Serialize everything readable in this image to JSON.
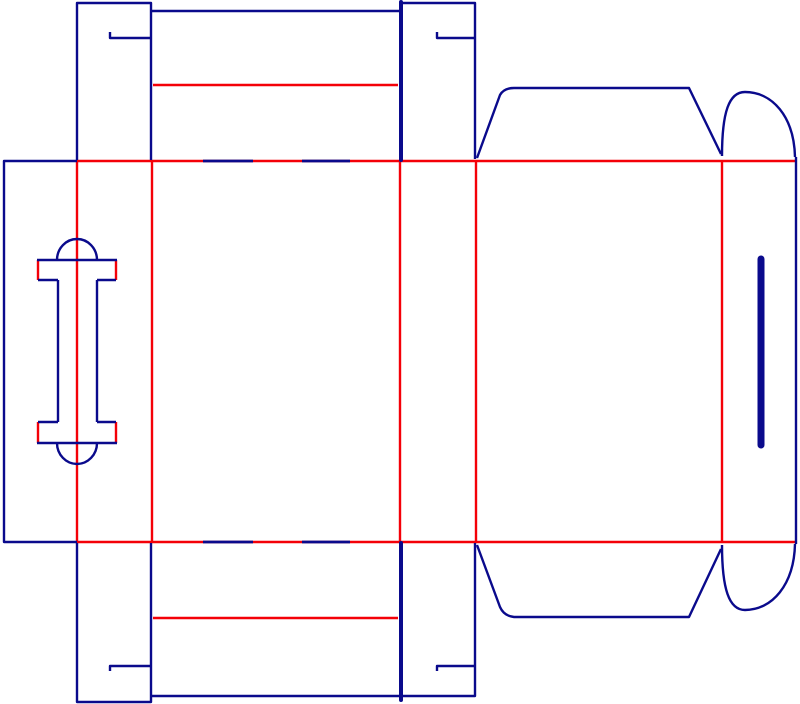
{
  "canvas": {
    "width": 800,
    "height": 704,
    "background": "#ffffff"
  },
  "colors": {
    "cut": "#0a0a8c",
    "crease": "#f40008"
  },
  "stroke": {
    "default": 2.4,
    "dash": 2.8,
    "flap_slit": 4,
    "thumb_slit": 7
  },
  "dieline": {
    "creases": [
      {
        "name": "fold-glue-flap",
        "points": "77,161 77,542"
      },
      {
        "name": "fold-handle-panel-right",
        "points": "152,161 152,542"
      },
      {
        "name": "fold-front-panel-right",
        "points": "400,161 400,542"
      },
      {
        "name": "fold-side-panel-right",
        "points": "476,161 476,542"
      },
      {
        "name": "fold-back-panel-right",
        "points": "722,161 722,542"
      },
      {
        "name": "crease-top-horizontal",
        "points": "77,161 795,161"
      },
      {
        "name": "crease-bottom-horizontal",
        "points": "77,542 795,542"
      },
      {
        "name": "crease-top-tuck-flap",
        "points": "153,85 398,85"
      },
      {
        "name": "crease-bottom-tuck-flap",
        "points": "153,618 398,618"
      },
      {
        "name": "crease-handle-top-left",
        "points": "38,260 38,280"
      },
      {
        "name": "crease-handle-top-right",
        "points": "116,260 116,280"
      },
      {
        "name": "crease-handle-bottom-left",
        "points": "38,422 38,443"
      },
      {
        "name": "crease-handle-bottom-right",
        "points": "116,422 116,443"
      }
    ],
    "cut_dashes": [
      {
        "name": "perforation-dash-top-1",
        "points": "203,161 253,161"
      },
      {
        "name": "perforation-dash-top-2",
        "points": "302,161 350,161"
      },
      {
        "name": "perforation-dash-bottom-1",
        "points": "203,542 253,542"
      },
      {
        "name": "perforation-dash-bottom-2",
        "points": "302,542 350,542"
      }
    ],
    "cuts": [
      {
        "name": "glue-flap-outline",
        "points": "77,161 4,161 4,542 77,542"
      },
      {
        "name": "top-dust-flap-left-outline",
        "points": "77,160 77,3 151,3 151,160"
      },
      {
        "name": "top-dust-flap-left-lock-slit",
        "points": "110,32 110,38 150,38"
      },
      {
        "name": "top-tuck-flap-top-edge",
        "points": "151,11 399,11"
      },
      {
        "name": "top-flap-slit",
        "points": "401,2 401,160",
        "width": 4,
        "cap": "round"
      },
      {
        "name": "top-dust-flap-right-outline",
        "points": "403,3 475,3 475,159"
      },
      {
        "name": "top-dust-flap-right-lock-slit",
        "points": "437,32 437,38 474,38"
      },
      {
        "name": "top-back-flap-outline",
        "d": "M 477,158 L 500,95 Q 504,88 514,88 L 689,88 L 721,154"
      },
      {
        "name": "top-ear-flap-curve",
        "d": "M 722,156 C 722,112 729,92 745,92 C 772,92 794,116 795,157"
      },
      {
        "name": "right-edge-cut",
        "points": "796,157 796,544"
      },
      {
        "name": "bottom-ear-flap-curve",
        "d": "M 722,545 C 722,589 729,610 745,610 C 772,610 794,585 795,544"
      },
      {
        "name": "bottom-back-flap-outline",
        "d": "M 477,545 L 500,607 Q 504,616 514,617 L 689,617 L 721,549"
      },
      {
        "name": "bottom-flap-slit",
        "points": "401,543 401,700",
        "width": 4,
        "cap": "round"
      },
      {
        "name": "bottom-dust-flap-right-outline",
        "points": "475,543 475,696 403,696"
      },
      {
        "name": "bottom-dust-flap-right-lock-slit",
        "points": "437,671 437,666 474,666"
      },
      {
        "name": "bottom-tuck-flap-bottom-edge",
        "points": "151,696 399,696"
      },
      {
        "name": "bottom-dust-flap-left-outline",
        "points": "77,543 77,702 151,702 151,543"
      },
      {
        "name": "bottom-dust-flap-left-lock-slit",
        "points": "110,671 110,666 150,666"
      },
      {
        "name": "handle-top-arc",
        "d": "M 57,260 A 20,21 0 0 1 97,260"
      },
      {
        "name": "handle-top-bar",
        "points": "37,260 117,260"
      },
      {
        "name": "handle-left-step-top",
        "points": "38,280 58,280"
      },
      {
        "name": "handle-left-inner-cut",
        "points": "58,280 58,422"
      },
      {
        "name": "handle-left-step-bottom",
        "points": "58,422 38,422"
      },
      {
        "name": "handle-right-step-top",
        "points": "116,280 97,280"
      },
      {
        "name": "handle-right-inner-cut",
        "points": "97,280 97,422"
      },
      {
        "name": "handle-right-step-bottom",
        "points": "97,422 116,422"
      },
      {
        "name": "handle-bottom-bar",
        "points": "37,443 117,443"
      },
      {
        "name": "handle-bottom-arc",
        "d": "M 57,443 A 20,21 0 0 0 97,443"
      },
      {
        "name": "thumb-slit",
        "points": "761,259 761,445",
        "width": 7,
        "cap": "round"
      }
    ]
  }
}
